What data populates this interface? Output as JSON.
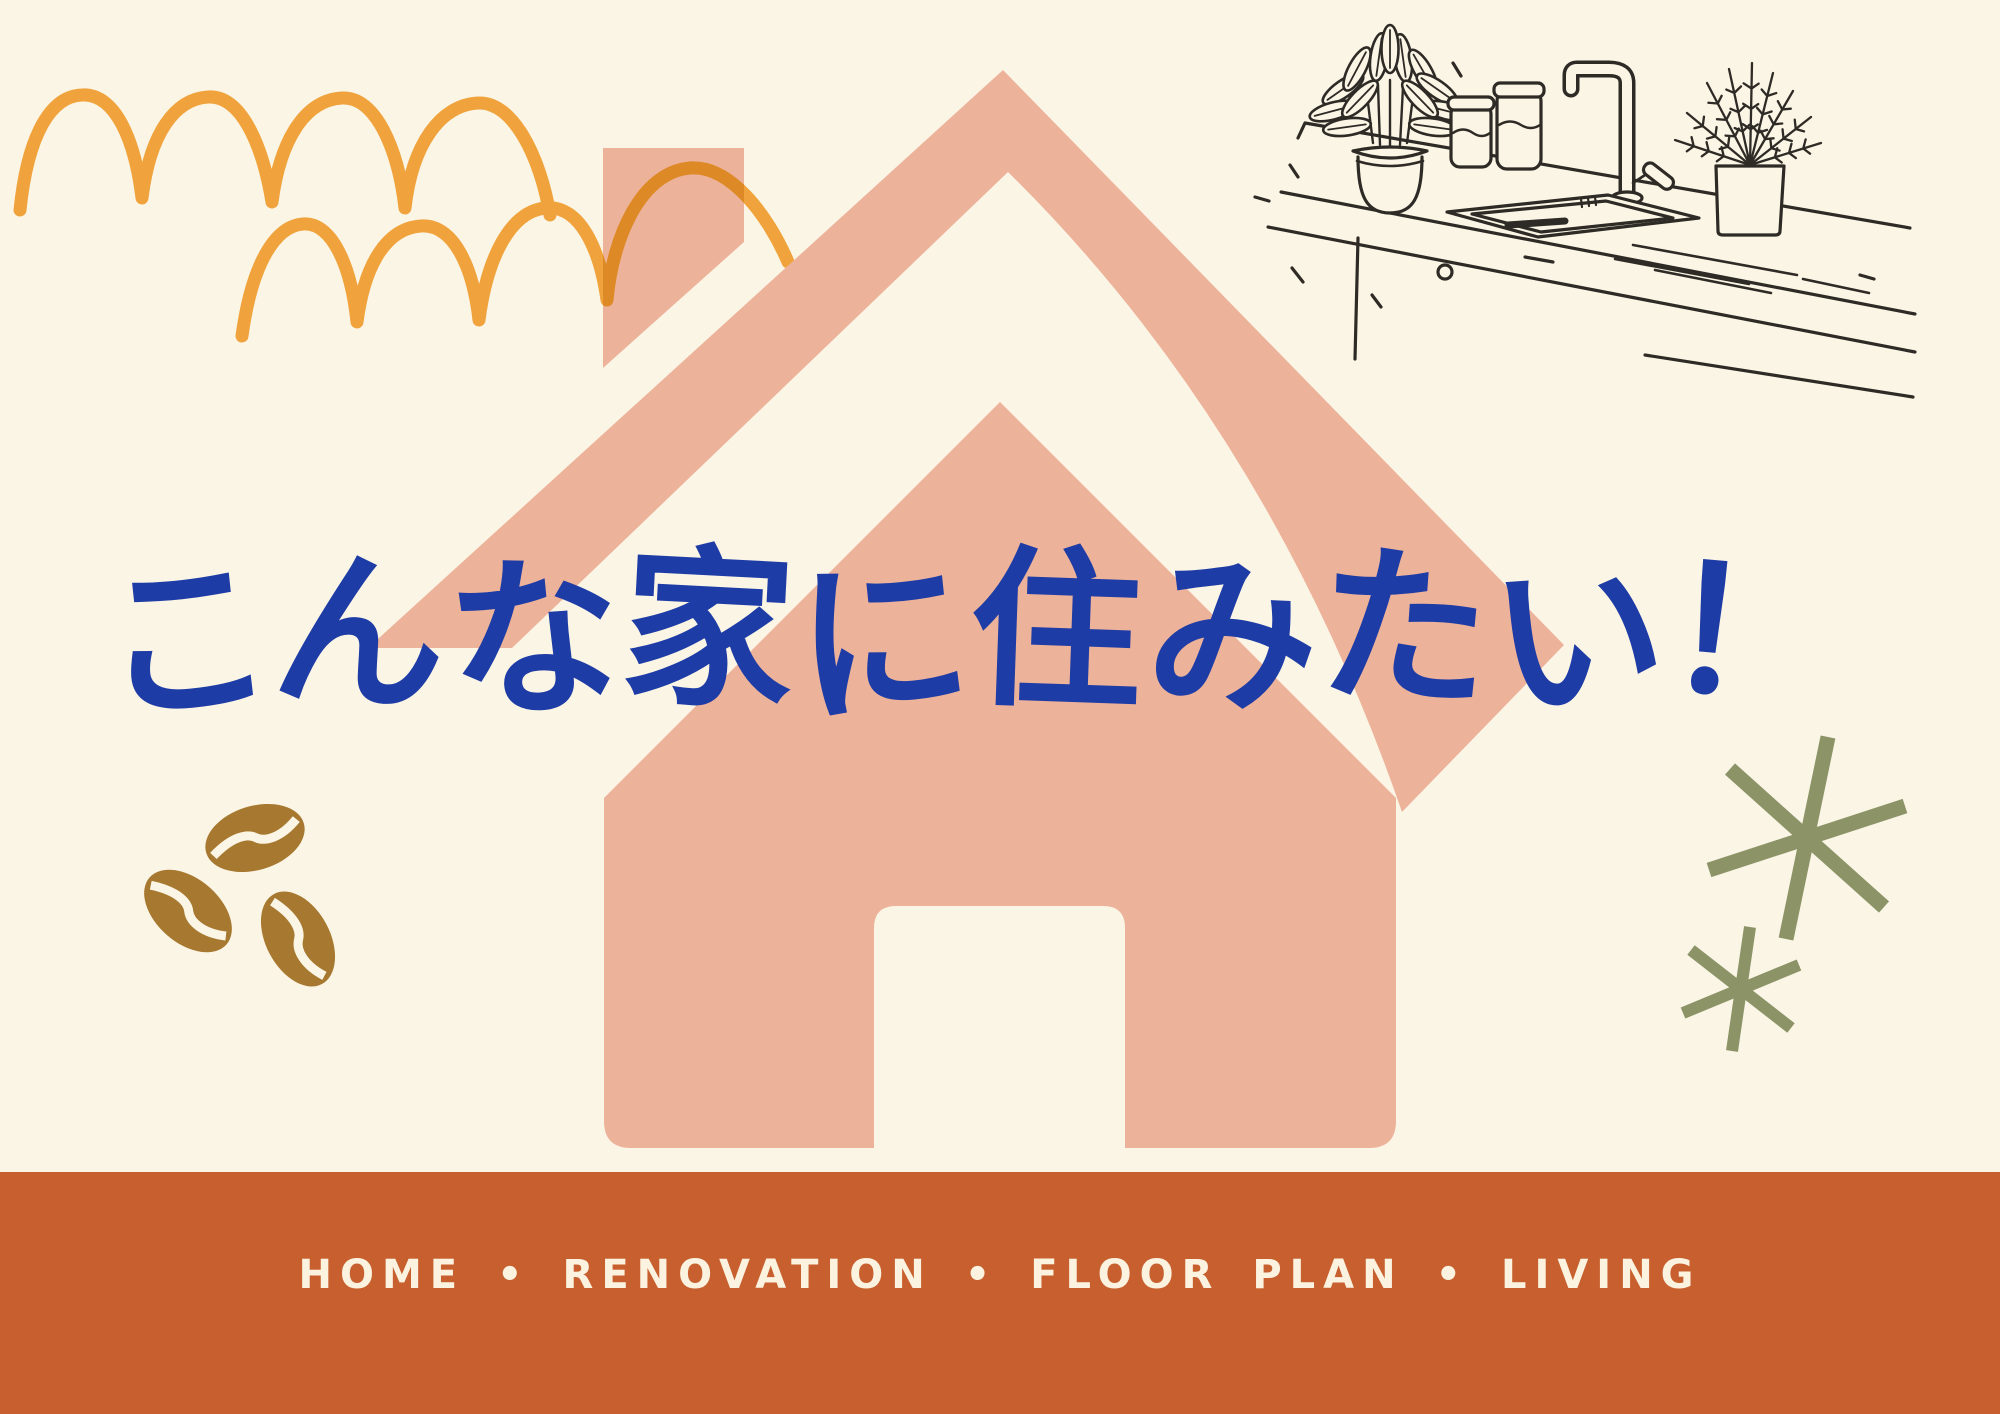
{
  "headline": {
    "text": "こんな家に住みたい！"
  },
  "footer": {
    "caption": "HOME • RENOVATION • FLOOR PLAN • LIVING"
  },
  "palette": {
    "background": "#FBF5E5",
    "house_salmon": "#EDB29A",
    "arc_orange": "#F0A33C",
    "arc_overlap_orange": "#DD8A26",
    "headline_blue": "#1E3CA6",
    "bar_rust": "#C7602E",
    "bar_text_cream": "#FBF2DF",
    "asterisk_olive": "#8B9367",
    "coffee_bean_brown": "#A7782F",
    "sketch_ink": "#2E2A25"
  },
  "illustrations": {
    "house": "large salmon house silhouette with chimney, outlined roof band and cream door",
    "roof_arcs": "two rows of hand-drawn orange roof-tile arches, top left",
    "kitchen_sketch": "ink line drawing of kitchen counter with sink, faucet, jars and two plants, top right",
    "coffee_beans": "three brown coffee beans, bottom left",
    "sparkles": "two olive green asterisk sparkles, right side"
  }
}
